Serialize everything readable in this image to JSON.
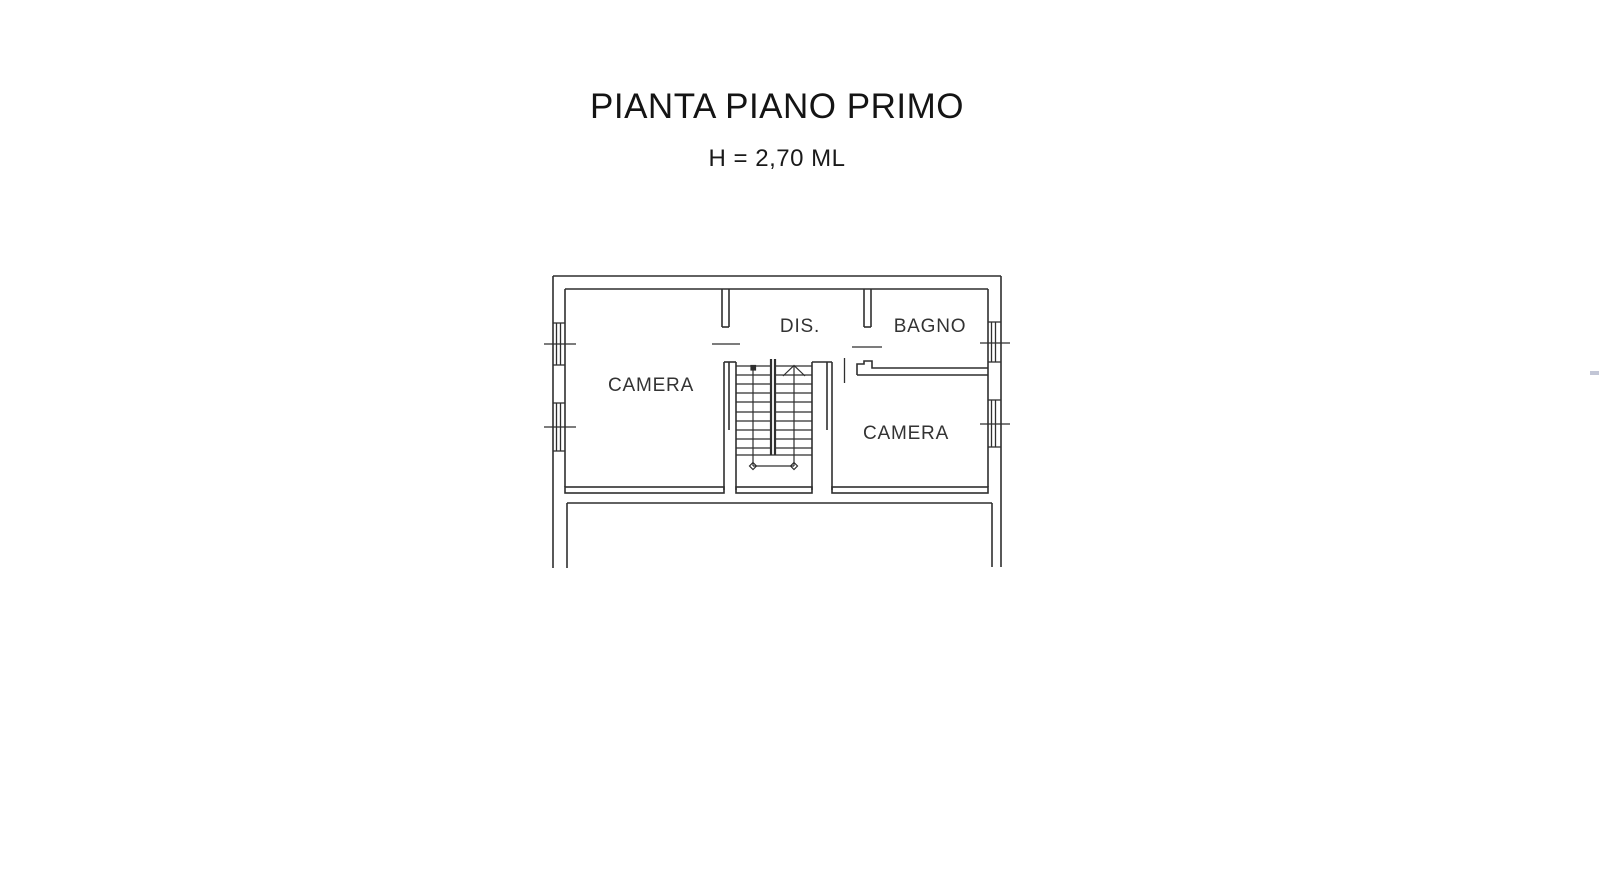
{
  "page": {
    "background_color": "#ffffff",
    "line_color": "#2f2f2f",
    "text_color": "#1a1a1a"
  },
  "header": {
    "title": "PIANTA PIANO PRIMO",
    "subtitle": "H = 2,70 ML"
  },
  "floor_plan": {
    "rooms": [
      {
        "id": "camera-left",
        "label": "CAMERA"
      },
      {
        "id": "disimpegno",
        "label": "DIS."
      },
      {
        "id": "bagno",
        "label": "BAGNO"
      },
      {
        "id": "camera-right",
        "label": "CAMERA"
      }
    ],
    "features": [
      "staircase-double-flight",
      "window-left-1",
      "window-left-2",
      "window-right-1",
      "window-right-2",
      "door-camera-left",
      "door-bagno",
      "door-camera-right"
    ]
  }
}
